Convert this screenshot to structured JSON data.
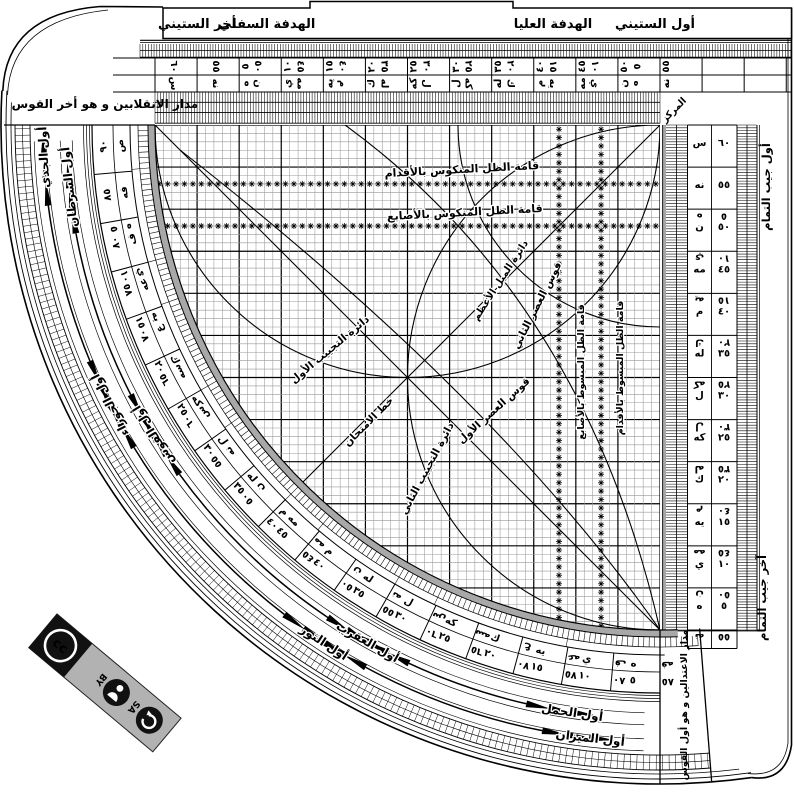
{
  "plate": {
    "bg": "#ffffff",
    "ink": "#000000",
    "arc_gray": "#a8a8a8",
    "badge_gray": "#b2b2b2"
  },
  "tabs": {
    "awwal_sittini": "أول الستيني",
    "hadafa_ulya": "الهدفة العليا",
    "hadafa_sufla": "الهدفة السفلي",
    "akhir_sittini": "أخر الستيني"
  },
  "corners": {
    "top_left": "مدار الانقلابين و هو أخر القوس",
    "bottom_right": "مدار الاعتدالين و هو أول القوس",
    "markaz": "المركز",
    "jayb_awwal": "أول جيب التمام",
    "jayb_akhir": "آخر جيب التمام"
  },
  "grid_labels": {
    "mankus_aqdam": "قامة الظل المنكوس بالأقدام",
    "mankus_asabi": "قامة الظل المنكوس بالأصابع",
    "mabsut_asabi": "قامة الظل المبسوط بالأصابع",
    "mabsut_aqdam": "قامة الظل المبسوط بالأقدام",
    "tajyib1": "دائرة التجييب الأول",
    "tajyib2": "دائرة التجييب الثاني",
    "mayl": "دائرة الميل الأعظم",
    "asr1": "قوس العصر الأول",
    "asr2": "قوس العصر الثاني",
    "imtihan": "خط الامتحان"
  },
  "scales": {
    "sixty": [
      {
        "v": 60,
        "n": "٦٠",
        "a": "س"
      },
      {
        "v": 55,
        "n": "٥٥",
        "a": "نه"
      },
      {
        "v": 50,
        "n": "٥٠",
        "a": "ن"
      },
      {
        "v": 45,
        "n": "٤٥",
        "a": "مه"
      },
      {
        "v": 40,
        "n": "٤٠",
        "a": "م"
      },
      {
        "v": 35,
        "n": "٣٥",
        "a": "له"
      },
      {
        "v": 30,
        "n": "٣٠",
        "a": "ل"
      },
      {
        "v": 25,
        "n": "٢٥",
        "a": "كه"
      },
      {
        "v": 20,
        "n": "٢٠",
        "a": "ك"
      },
      {
        "v": 15,
        "n": "١٥",
        "a": "يه"
      },
      {
        "v": 10,
        "n": "١٠",
        "a": "ي"
      },
      {
        "v": 5,
        "n": "٥",
        "a": "ه"
      }
    ],
    "ninety": [
      {
        "v": 90,
        "n": "٩٠",
        "a": "ص"
      },
      {
        "v": 85,
        "n": "٨٥",
        "a": "فه"
      },
      {
        "v": 80,
        "n": "٨٠",
        "a": "ف"
      },
      {
        "v": 75,
        "n": "٧٥",
        "a": "عه"
      },
      {
        "v": 70,
        "n": "٧٠",
        "a": "ع"
      },
      {
        "v": 65,
        "n": "٦٥",
        "a": "سه"
      },
      {
        "v": 60,
        "n": "٦٠",
        "a": "س"
      },
      {
        "v": 55,
        "n": "٥٥",
        "a": "نه"
      },
      {
        "v": 50,
        "n": "٥٠",
        "a": "ن"
      },
      {
        "v": 45,
        "n": "٤٥",
        "a": "مه"
      },
      {
        "v": 40,
        "n": "٤٠",
        "a": "م"
      },
      {
        "v": 35,
        "n": "٣٥",
        "a": "له"
      },
      {
        "v": 30,
        "n": "٣٠",
        "a": "ل"
      },
      {
        "v": 25,
        "n": "٢٥",
        "a": "كه"
      },
      {
        "v": 20,
        "n": "٢٠",
        "a": "ك"
      },
      {
        "v": 15,
        "n": "١٥",
        "a": "يه"
      },
      {
        "v": 10,
        "n": "١٠",
        "a": "ي"
      },
      {
        "v": 5,
        "n": "٥",
        "a": "ه"
      }
    ]
  },
  "zodiac": {
    "outer": [
      {
        "label": "أول الجدي",
        "v": 87
      },
      {
        "label": "أول الجوزاء",
        "v": 63
      },
      {
        "label": "أول الثور",
        "v": 33
      },
      {
        "label": "أول الميزان",
        "v": 6.5
      }
    ],
    "inner": [
      {
        "label": "أول السرطان",
        "v": 84
      },
      {
        "label": "أول القوس",
        "v": 58.5
      },
      {
        "label": "أول العقرب",
        "v": 29.5
      },
      {
        "label": "أول الحمل",
        "v": 8.5
      }
    ]
  },
  "license": {
    "cc": "cc",
    "by": "BY",
    "sa": "SA"
  }
}
